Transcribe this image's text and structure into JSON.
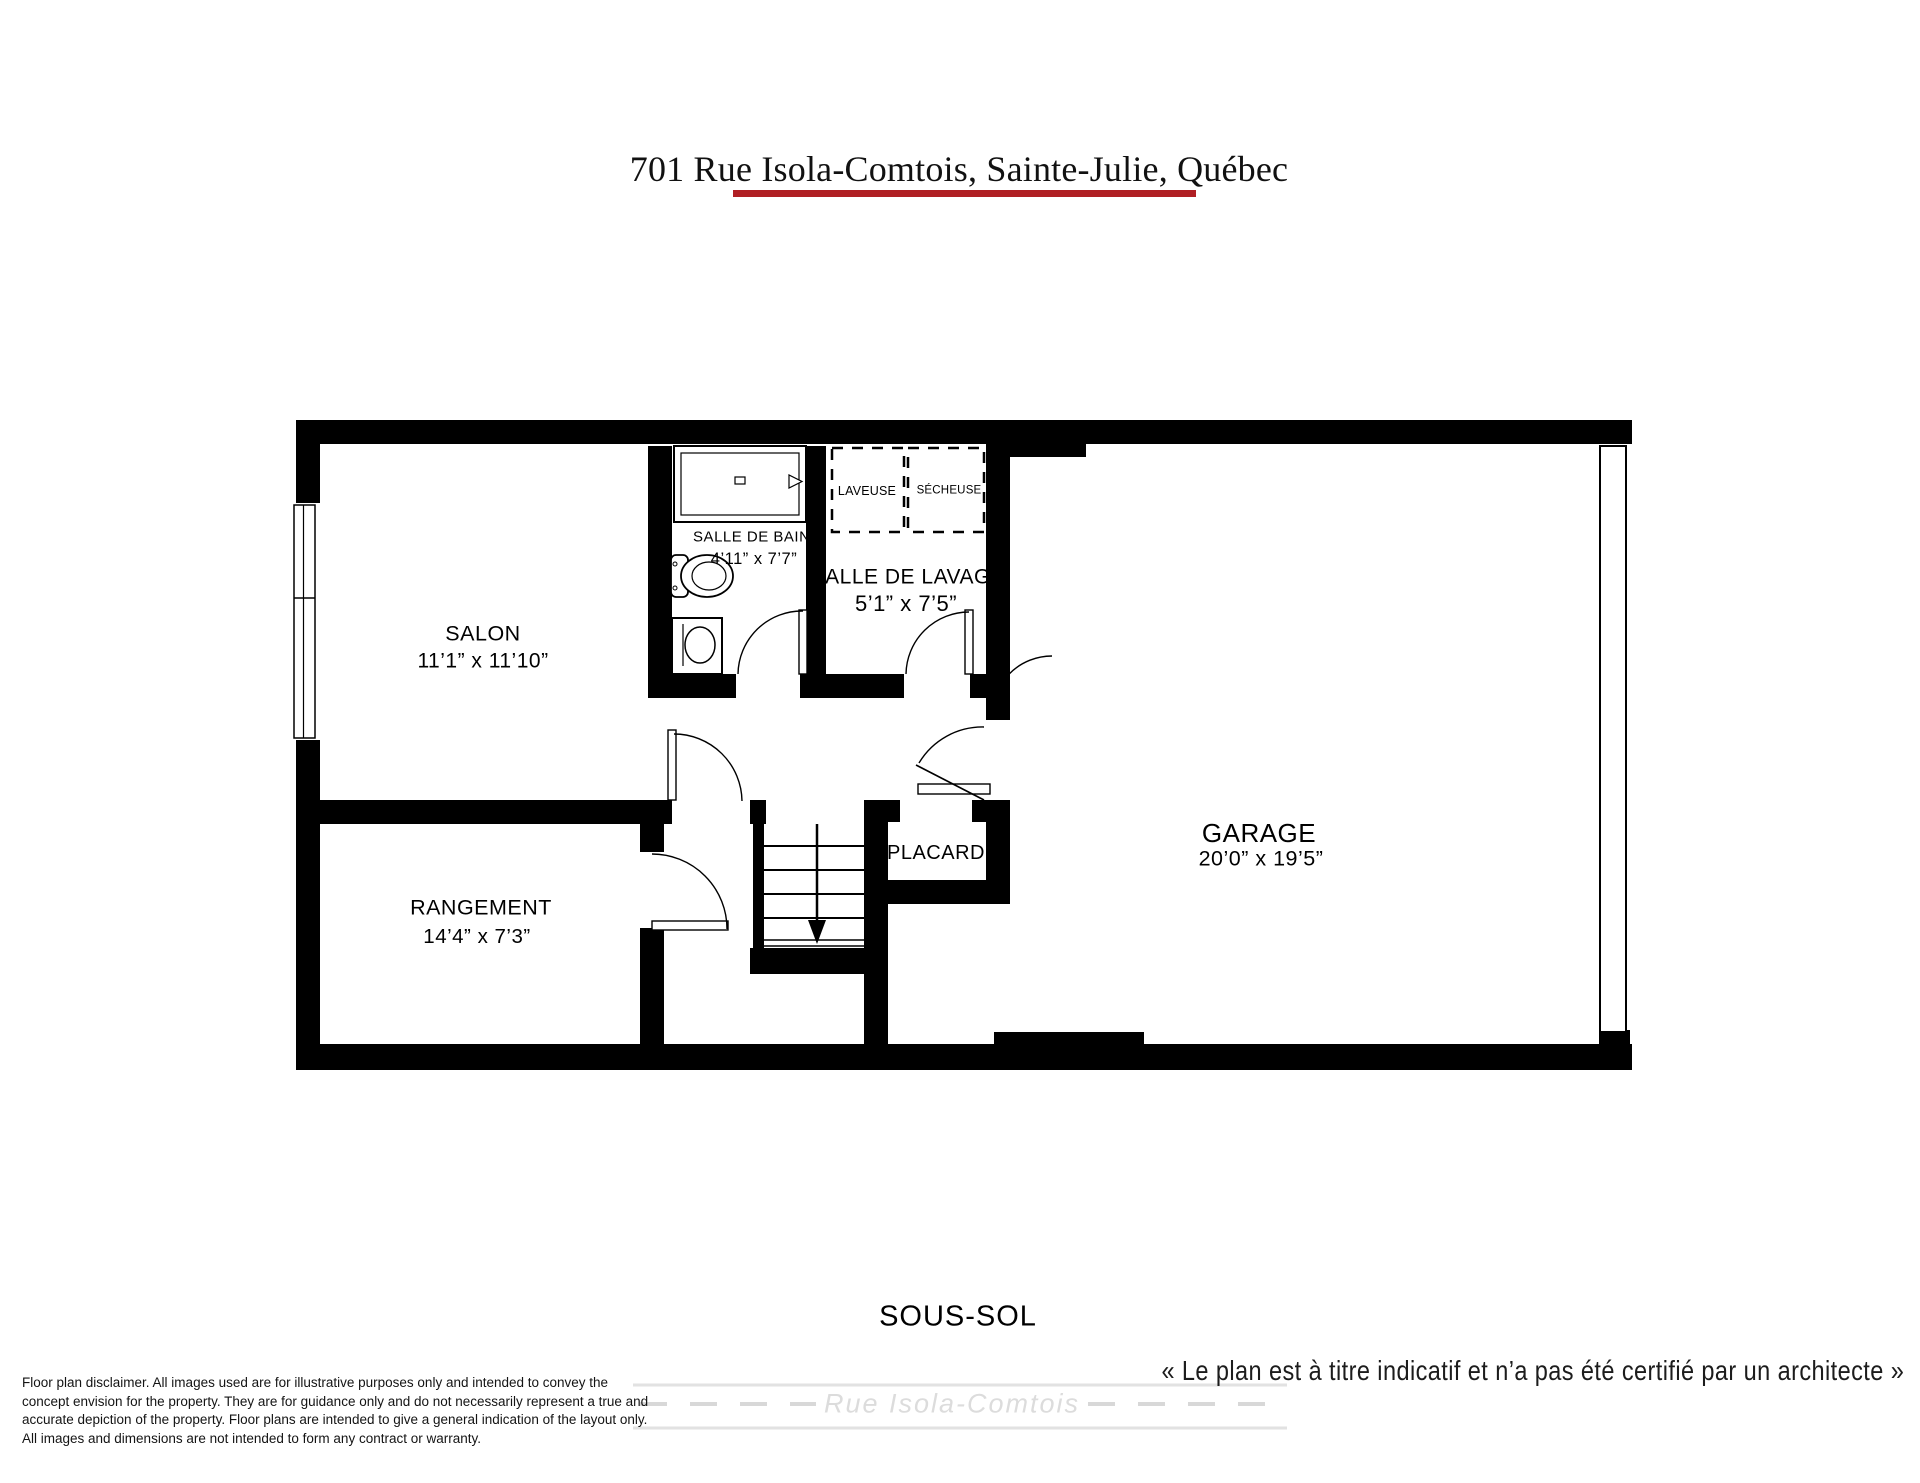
{
  "title": "701 Rue Isola-Comtois, Sainte-Julie, Québec",
  "floor_label": "SOUS-SOL",
  "rooms": {
    "salon": {
      "name": "SALON",
      "dims": "11’1” x 11’10”"
    },
    "salle_de_bains": {
      "name": "SALLE DE BAINS",
      "dims": "4’11” x 7’7”"
    },
    "salle_de_lavage": {
      "name": "SALLE DE LAVAGE",
      "dims": "5’1” x 7’5”"
    },
    "garage": {
      "name": "GARAGE",
      "dims": "20’0” x 19’5”"
    },
    "rangement": {
      "name": "RANGEMENT",
      "dims": "14’4” x 7’3”"
    },
    "placard": {
      "name": "PLACARD"
    }
  },
  "appliances": {
    "washer": "LAVEUSE",
    "dryer": "SÉCHEUSE"
  },
  "footer": {
    "quote": "« Le plan est à titre indicatif et n’a pas été certifié par un architecte »",
    "disclaimer_lines": [
      "Floor plan disclaimer. All images used are for illustrative purposes only and intended to convey the",
      "concept envision for the property. They are for guidance only and do not necessarily represent a true and",
      "accurate depiction of the property. Floor plans are intended to give a general indication of the layout only.",
      "All images and dimensions are not intended to form any contract or warranty."
    ],
    "street_watermark": "Rue Isola-Comtois"
  },
  "colors": {
    "accent_underline": "#b01f24",
    "ink": "#000000",
    "watermark": "#dcdcdc"
  }
}
